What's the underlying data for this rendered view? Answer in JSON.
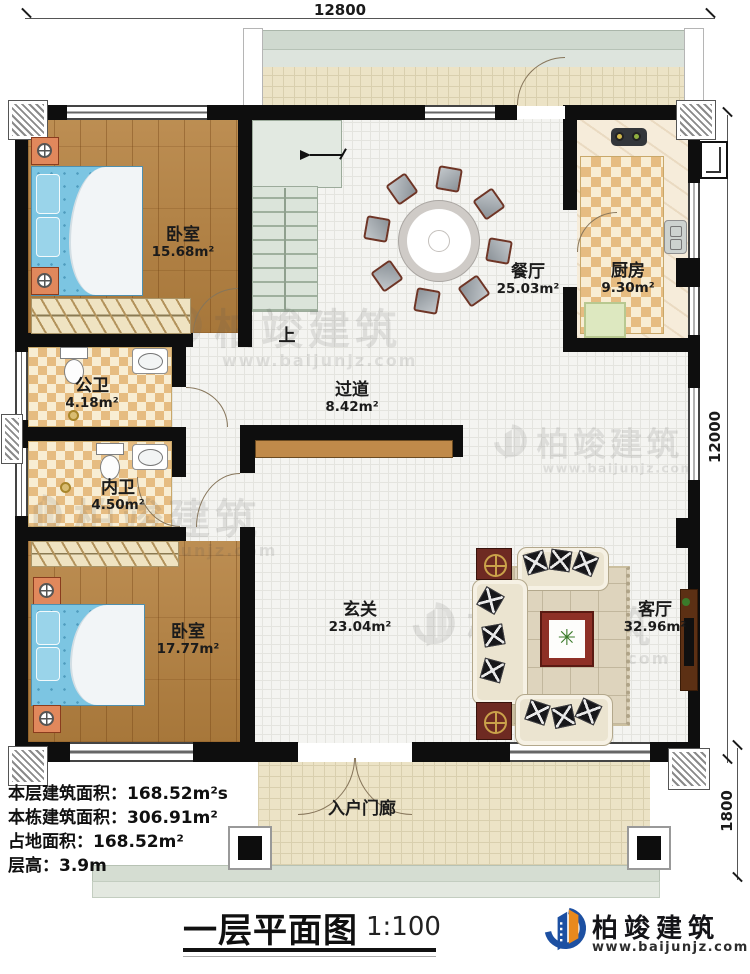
{
  "drawing": {
    "title": "一层平面图",
    "scale": "1:100"
  },
  "dimensions": {
    "top": "12800",
    "right": "12000",
    "bottom_right": "1800"
  },
  "rooms": [
    {
      "id": "bedroom1",
      "name": "卧室",
      "area": "15.68m²"
    },
    {
      "id": "dining",
      "name": "餐厅",
      "area": "25.03m²"
    },
    {
      "id": "kitchen",
      "name": "厨房",
      "area": "9.30m²"
    },
    {
      "id": "public-bath",
      "name": "公卫",
      "area": "4.18m²"
    },
    {
      "id": "inner-bath",
      "name": "内卫",
      "area": "4.50m²"
    },
    {
      "id": "hallway",
      "name": "过道",
      "area": "8.42m²"
    },
    {
      "id": "bedroom2",
      "name": "卧室",
      "area": "17.77m²"
    },
    {
      "id": "foyer",
      "name": "玄关",
      "area": "23.04m²"
    },
    {
      "id": "living",
      "name": "客厅",
      "area": "32.96m²"
    },
    {
      "id": "porch",
      "name": "入户门廊",
      "area": ""
    }
  ],
  "stairs": {
    "label": "上"
  },
  "info": {
    "floor_area": "本层建筑面积：168.52m²s",
    "total_area": "本栋建筑面积：306.91m²",
    "land_area": "占地面积：168.52m²",
    "floor_height": "层高：3.9m"
  },
  "brand": {
    "name": "柏竣建筑",
    "url": "www.baijunjz.com",
    "blue": "#1d50a2",
    "orange": "#e8891d"
  }
}
